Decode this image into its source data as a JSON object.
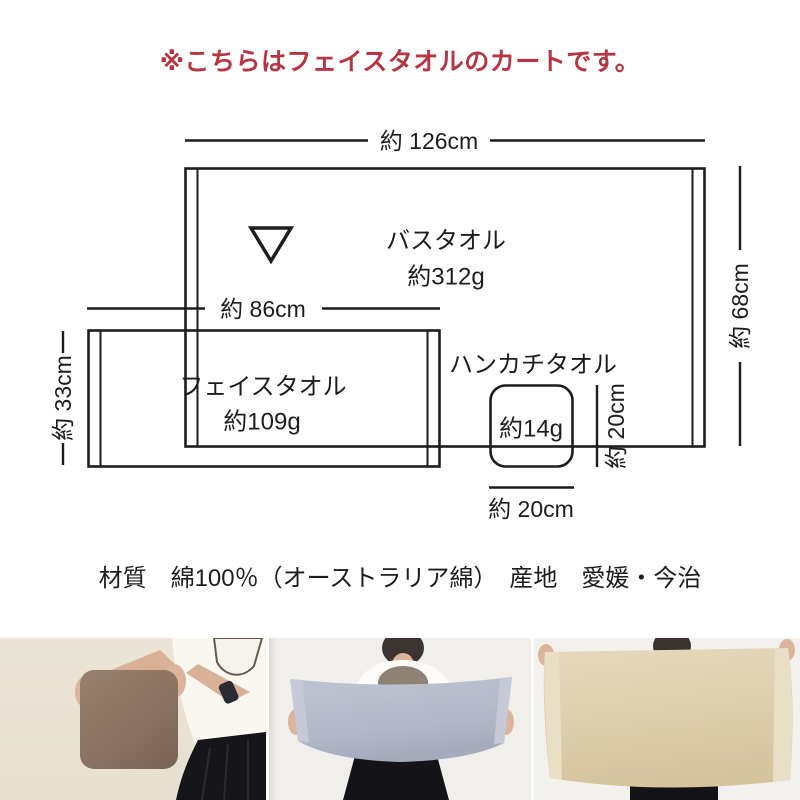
{
  "notice": "※こちらはフェイスタオルのカートです。",
  "diagram": {
    "bath_towel": {
      "name": "バスタオル",
      "weight": "約312g",
      "width_label": "約 126cm",
      "height_label": "約 68cm"
    },
    "face_towel": {
      "name": "フェイスタオル",
      "weight": "約109g",
      "width_label": "約 86cm",
      "height_label": "約 33cm"
    },
    "hand_towel": {
      "name": "ハンカチタオル",
      "weight": "約14g",
      "width_label": "約 20cm",
      "height_label": "約 20cm"
    }
  },
  "specs_line": "材質　綿100％（オーストラリア綿）　産地　愛媛・今治",
  "colors": {
    "accent_red": "#b73540",
    "diagram_line": "#1d1d1d",
    "hand_towel_brown": "#8d7464",
    "face_towel_blue_gray": "#b3b9c8",
    "bath_towel_beige": "#decfaf"
  }
}
